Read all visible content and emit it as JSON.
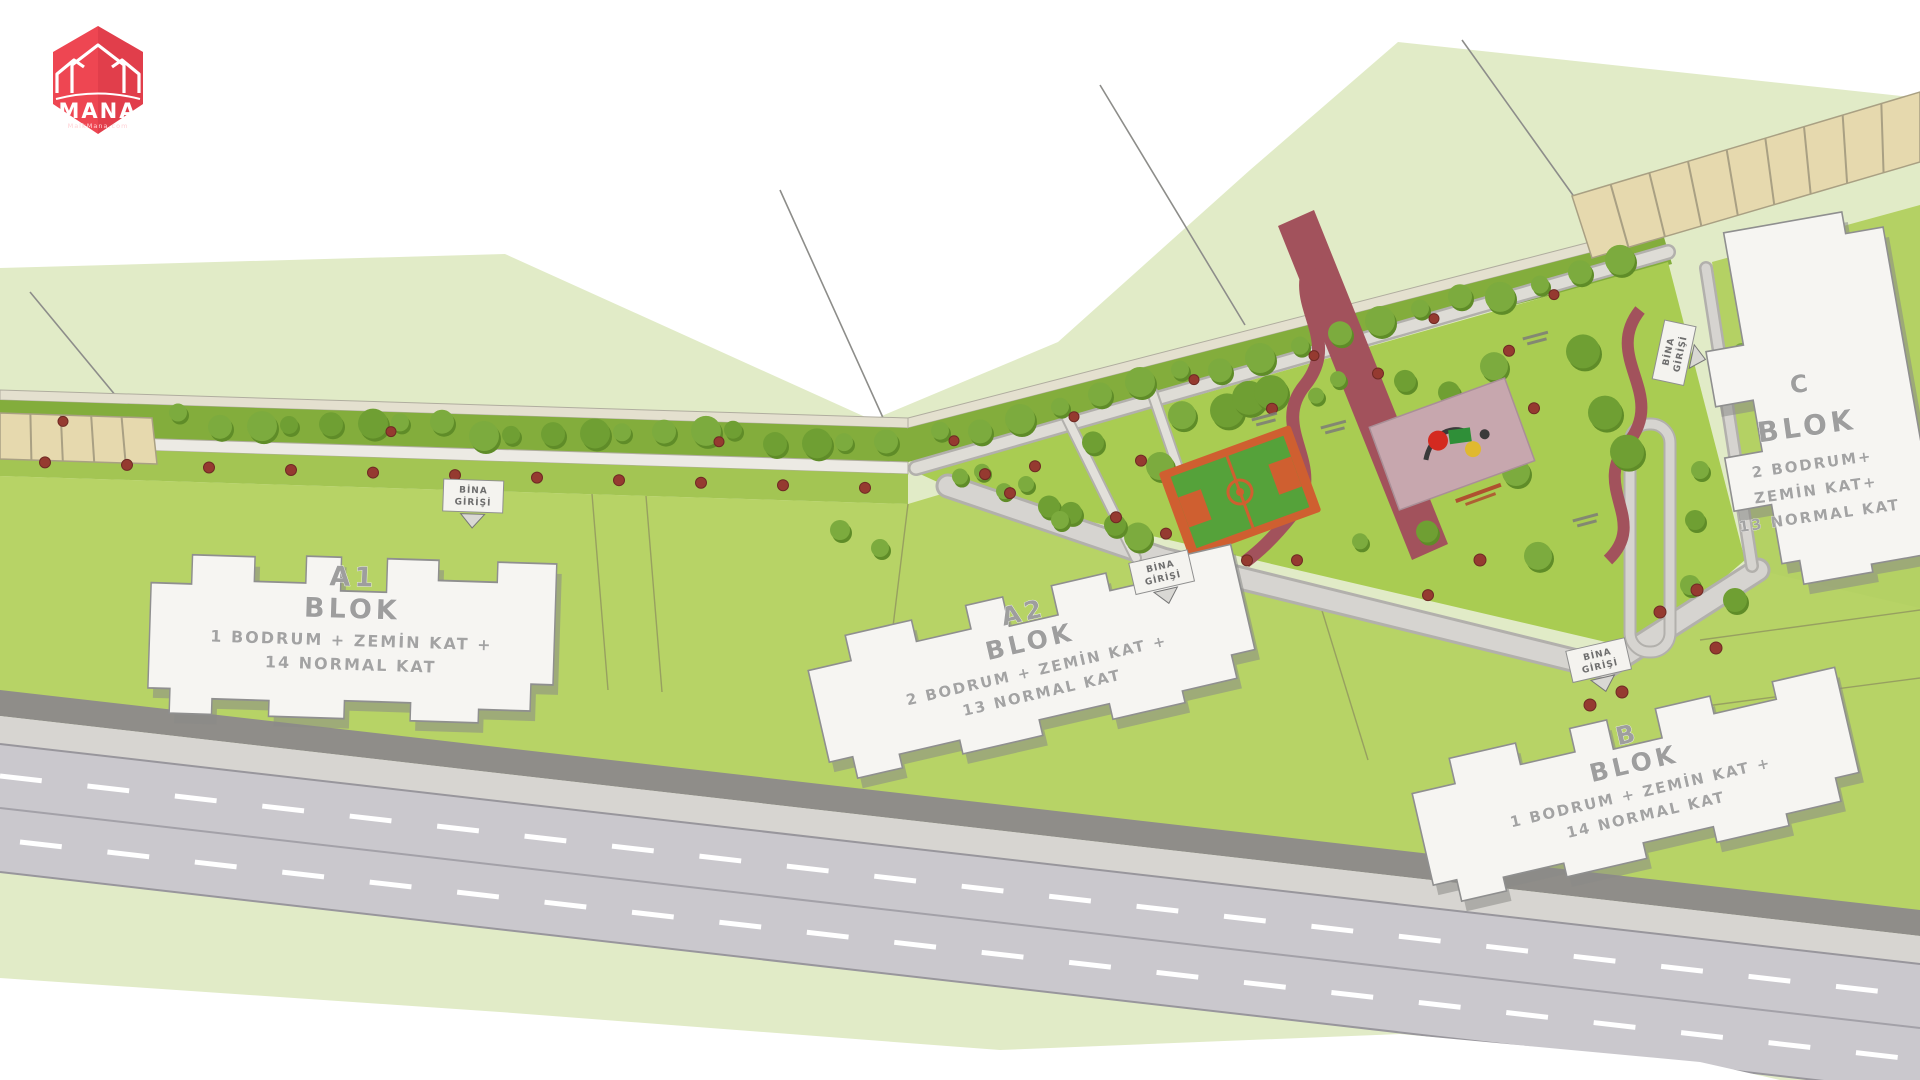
{
  "brand": {
    "name": "MANA",
    "site": "MalkMana.com"
  },
  "blocks": {
    "a1": {
      "name": "A1",
      "type": "BLOK",
      "floors1": "1 BODRUM + ZEMİN KAT +",
      "floors2": "14 NORMAL KAT"
    },
    "a2": {
      "name": "A2",
      "type": "BLOK",
      "floors1": "2 BODRUM + ZEMİN KAT +",
      "floors2": "13 NORMAL KAT"
    },
    "b": {
      "name": "B",
      "type": "BLOK",
      "floors1": "1 BODRUM + ZEMİN KAT +",
      "floors2": "14 NORMAL KAT"
    },
    "c": {
      "name": "C",
      "type": "BLOK",
      "floors1": "2 BODRUM+",
      "floors2": "ZEMİN KAT+",
      "floors3": "13 NORMAL KAT"
    }
  },
  "entrance": {
    "line1": "BİNA",
    "line2": "GİRİŞİ"
  },
  "colors": {
    "background": "#ffffff",
    "terrain": "#e1ebc7",
    "lawn": "#b7d366",
    "park": "#a9cc52",
    "tree_band": "#83ad3c",
    "tree_dark": "#5f8c28",
    "tree_main": "#6f9f33",
    "tree_alt": "#7cab3e",
    "bush_red": "#953a30",
    "path_light": "#d6d4d0",
    "path_casing": "#b2b0ac",
    "walkway": "#eceae4",
    "road": "#cac8cd",
    "sidewalk": "#d7d5d1",
    "wall": "#8f8d89",
    "building": "#f6f5f2",
    "building_edge": "#8f8f8f",
    "court_border": "#cf5f30",
    "court_field": "#55a23a",
    "playground": "#c7a7ae",
    "trail_maroon": "#a2525c",
    "parking": "#e6d9ae",
    "parking_line": "#a9a083",
    "brand_red": "#ee4652"
  }
}
